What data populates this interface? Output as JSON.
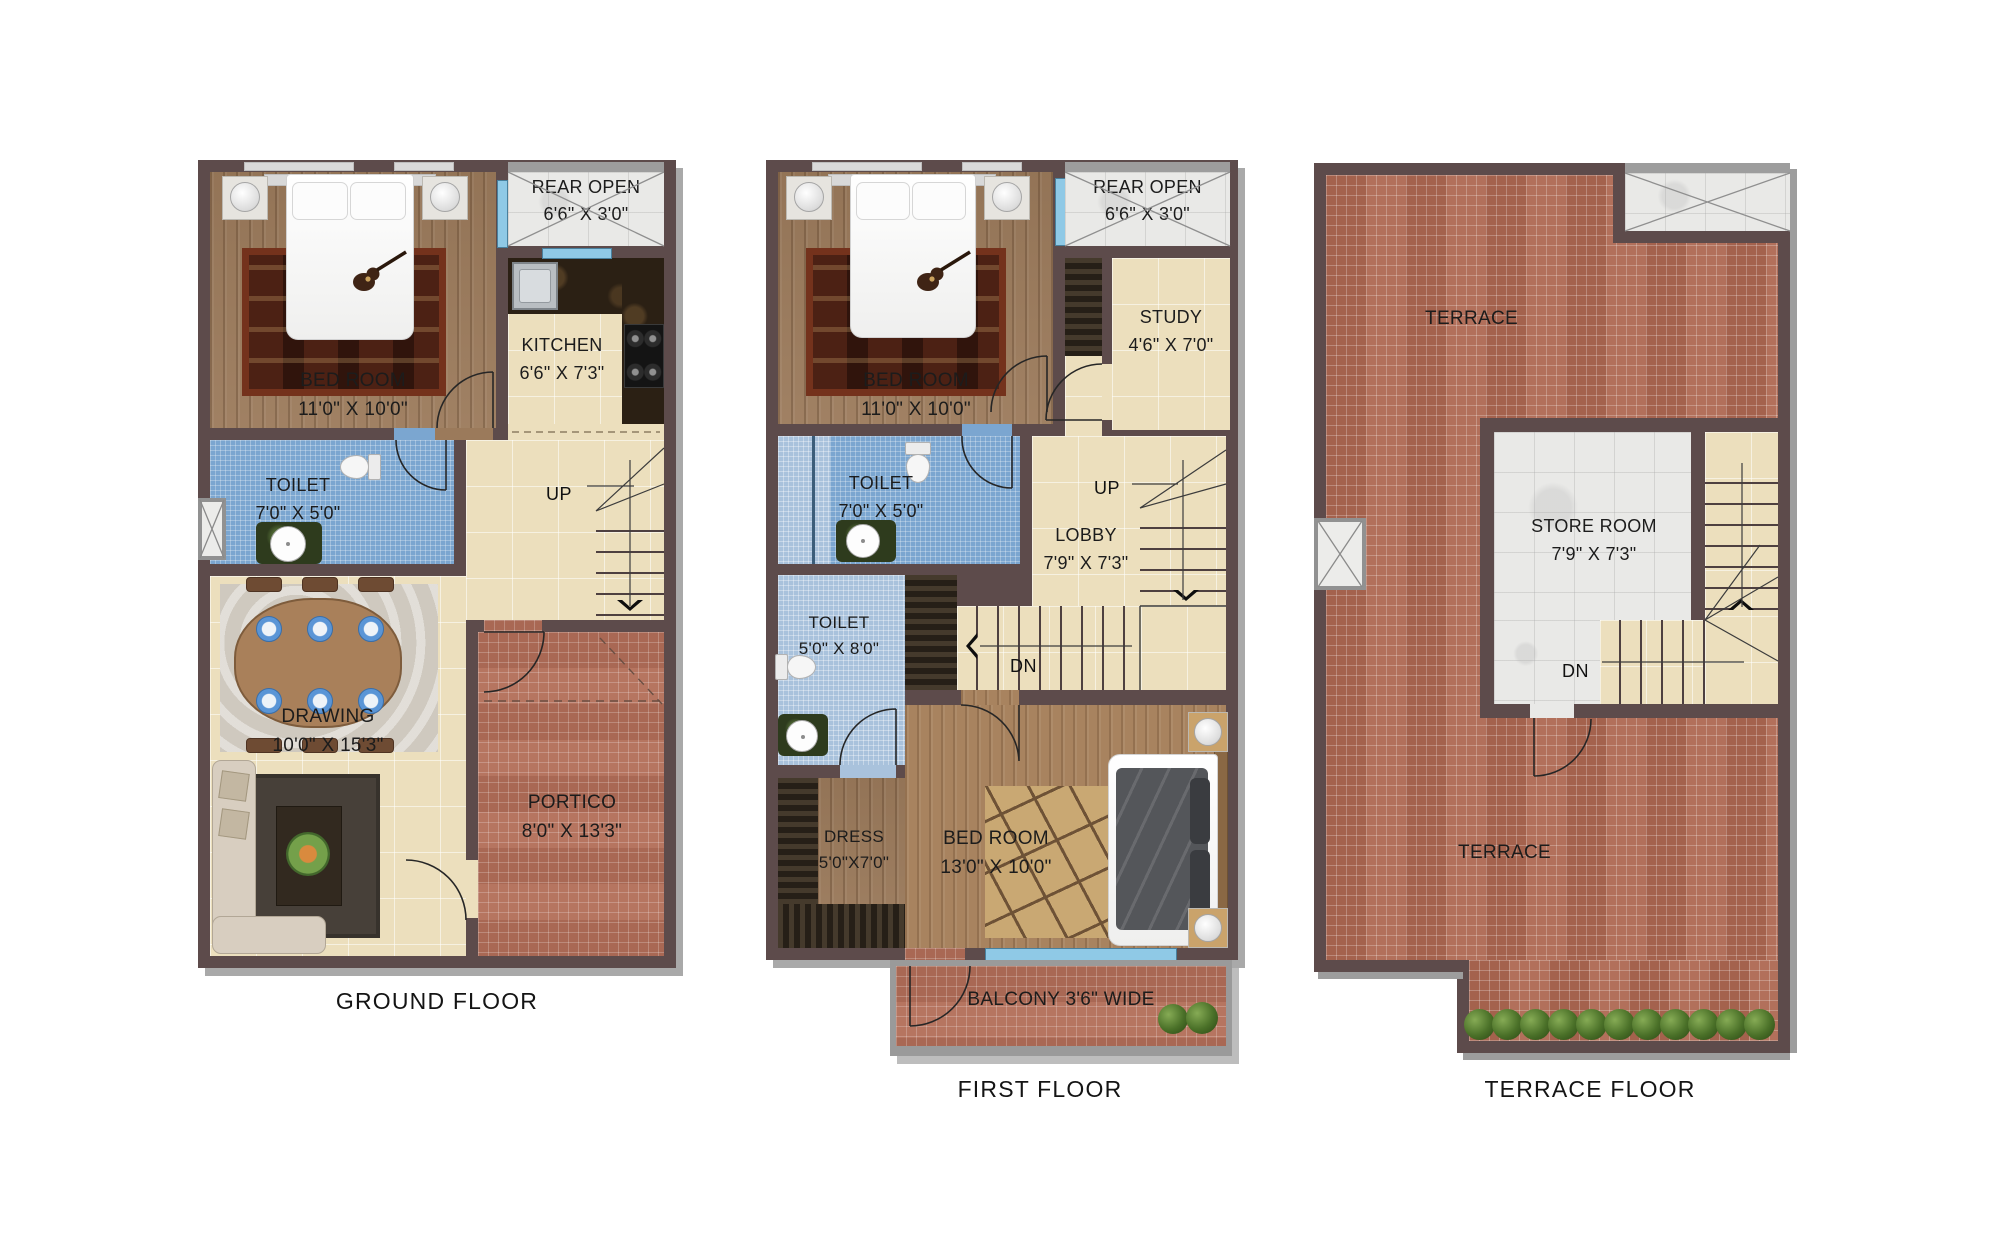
{
  "palette": {
    "wall": "#5d4b4b",
    "wood_floor": "#9b7a5b",
    "cream_floor": "#ecdfbd",
    "blue_tile": "#7ba6d0",
    "brick_tile": "#b26e58",
    "white_marble": "#e9e9e7",
    "outer_band": "#9d9d9d"
  },
  "floors": {
    "ground": {
      "title": "GROUND FLOOR",
      "bedroom": {
        "name": "BED ROOM",
        "size": "11'0\" X 10'0\""
      },
      "rear_open": {
        "name": "REAR OPEN",
        "size": "6'6\" X 3'0\""
      },
      "kitchen": {
        "name": "KITCHEN",
        "size": "6'6\" X 7'3\""
      },
      "toilet": {
        "name": "TOILET",
        "size": "7'0\" X 5'0\""
      },
      "lobby": {
        "name": "LOBBY",
        "size": "7'9\" X 7'3\""
      },
      "drawing": {
        "name": "DRAWING",
        "size": "10'0\" X 15'3\""
      },
      "portico": {
        "name": "PORTICO",
        "size": "8'0\" X 13'3\""
      },
      "up": "UP"
    },
    "first": {
      "title": "FIRST FLOOR",
      "bedroom1": {
        "name": "BED ROOM",
        "size": "11'0\" X 10'0\""
      },
      "rear_open": {
        "name": "REAR OPEN",
        "size": "6'6\" X 3'0\""
      },
      "study": {
        "name": "STUDY",
        "size": "4'6\" X 7'0\""
      },
      "toilet1": {
        "name": "TOILET",
        "size": "7'0\" X 5'0\""
      },
      "lobby": {
        "name": "LOBBY",
        "size": "7'9\" X 7'3\""
      },
      "toilet2": {
        "name": "TOILET",
        "size": "5'0\" X 8'0\""
      },
      "dress": {
        "name": "DRESS",
        "size": "5'0\"X7'0\""
      },
      "bedroom2": {
        "name": "BED ROOM",
        "size": "13'0\" X 10'0\""
      },
      "balcony": "BALCONY 3'6\" WIDE",
      "up": "UP",
      "dn": "DN"
    },
    "terrace": {
      "title": "TERRACE FLOOR",
      "terrace_top": "TERRACE",
      "store": {
        "name": "STORE ROOM",
        "size": "7'9\" X 7'3\""
      },
      "terrace_bottom": "TERRACE",
      "dn": "DN"
    }
  }
}
